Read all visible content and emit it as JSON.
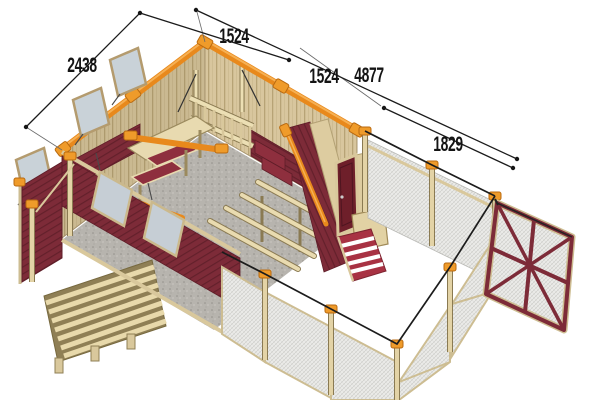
{
  "figure": {
    "subject": "3D chicken coop construction plan with fenced wire-mesh run",
    "view": "isometric cutaway",
    "background": "#ffffff"
  },
  "dimension_labels": {
    "left_side_depth": "2438",
    "back_left_section": "1524",
    "back_right_section": "1524",
    "overall_length": "4877",
    "run_gate_section": "1829"
  },
  "colors": {
    "beam_orange": "#e8891c",
    "beam_orange_light": "#f6b053",
    "wall_tan": "#d8c69e",
    "wood_light": "#e9dbb0",
    "wood_frame": "#cdbd92",
    "wall_maroon": "#7d2b38",
    "door_maroon": "#6e1f2a",
    "ramp_red": "#a83243",
    "floor_gray": "#b7b4ae",
    "mesh_gray": "#ecece9",
    "glass_gray": "#c6ced5",
    "line_black": "#1b1b1b"
  }
}
